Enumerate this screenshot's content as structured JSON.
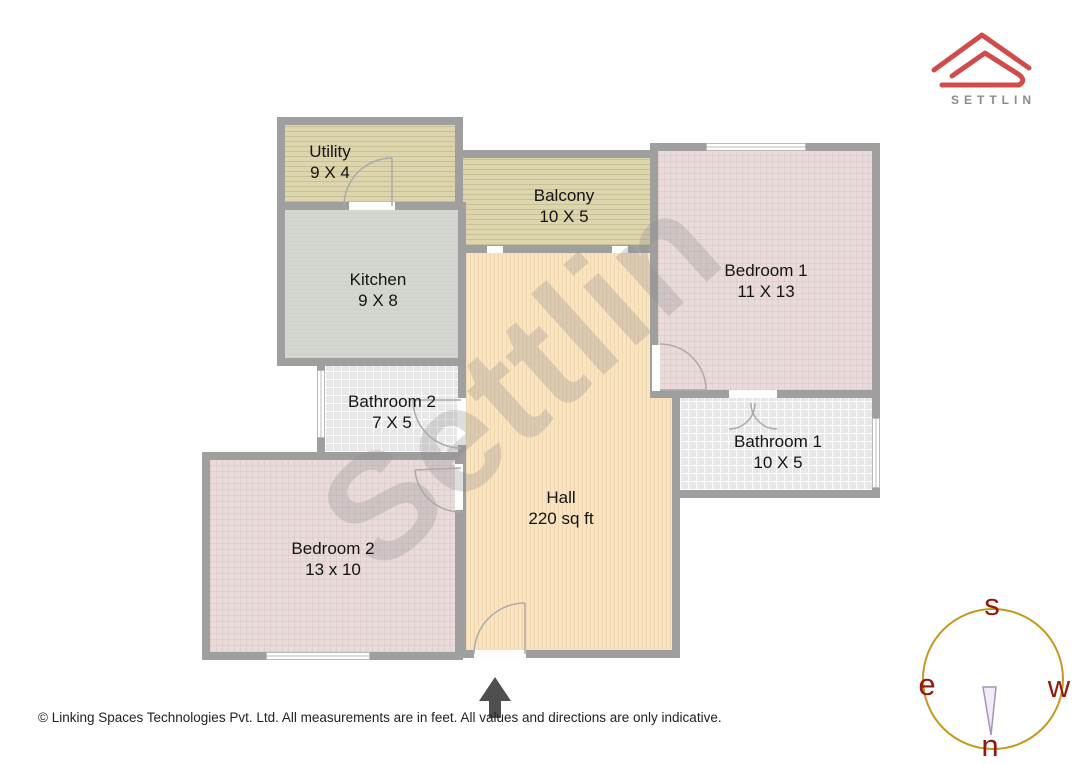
{
  "brand": {
    "logo_text": "SETTLIN"
  },
  "watermark": {
    "text": "Settlin"
  },
  "rooms": {
    "utility": {
      "name": "Utility",
      "dims": "9 X 4"
    },
    "kitchen": {
      "name": "Kitchen",
      "dims": "9 X 8"
    },
    "balcony": {
      "name": "Balcony",
      "dims": "10 X 5"
    },
    "bedroom1": {
      "name": "Bedroom 1",
      "dims": "11 X 13"
    },
    "bathroom1": {
      "name": "Bathroom 1",
      "dims": "10 X 5"
    },
    "bathroom2": {
      "name": "Bathroom 2",
      "dims": "7 X 5"
    },
    "bedroom2": {
      "name": "Bedroom 2",
      "dims": "13 x 10"
    },
    "hall": {
      "name": "Hall",
      "dims": "220 sq ft"
    }
  },
  "compass": {
    "top": "s",
    "left": "e",
    "right": "w",
    "bottom": "n"
  },
  "footer": {
    "copyright": "© Linking Spaces Technologies Pvt. Ltd. All measurements are in feet. All values and directions are only indicative."
  },
  "colors": {
    "accent_red": "#d14b4b",
    "wall_gray": "#9f9f9f",
    "compass_circle_gold": "#c7981f",
    "compass_letter_red": "#911a0e"
  }
}
